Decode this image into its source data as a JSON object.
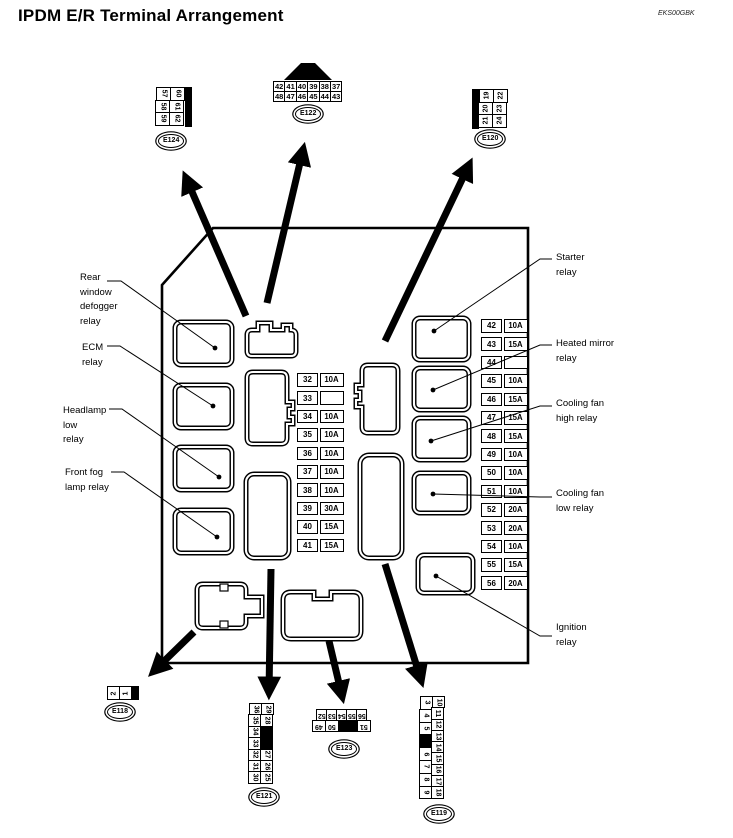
{
  "header": {
    "title": "IPDM E/R Terminal Arrangement",
    "doc_code": "EKS00GBK"
  },
  "colors": {
    "ink": "#000000",
    "paper": "#ffffff"
  },
  "labels": {
    "rear_window": [
      "Rear",
      "window",
      "defogger",
      "relay"
    ],
    "ecm": [
      "ECM",
      "relay"
    ],
    "headlamp_low": [
      "Headlamp",
      "low",
      "relay"
    ],
    "front_fog": [
      "Front fog",
      "lamp relay"
    ],
    "starter": [
      "Starter",
      "relay"
    ],
    "heated_mirror": [
      "Heated mirror",
      "relay"
    ],
    "cooling_fan_high": [
      "Cooling fan",
      "high relay"
    ],
    "cooling_fan_low": [
      "Cooling fan",
      "low relay"
    ],
    "ignition": [
      "Ignition",
      "relay"
    ]
  },
  "connectors": {
    "e122": {
      "label": "E122",
      "row_top": [
        "42",
        "41",
        "40",
        "39",
        "38",
        "37"
      ],
      "row_bottom": [
        "48",
        "47",
        "46",
        "45",
        "44",
        "43"
      ]
    },
    "e124": {
      "label": "E124",
      "col_left": [
        "57",
        "58",
        "59"
      ],
      "col_right": [
        "60",
        "61",
        "62"
      ]
    },
    "e120": {
      "label": "E120",
      "col_left": [
        "19",
        "20",
        "21"
      ],
      "col_right": [
        "22",
        "23",
        "24"
      ]
    },
    "e118": {
      "label": "E118",
      "cells": [
        "2",
        "1",
        null
      ]
    },
    "e121": {
      "label": "E121",
      "col_left": [
        "36",
        "35",
        "34",
        "33",
        "32",
        "31",
        "30"
      ],
      "col_right": [
        "29",
        "28",
        null,
        "27",
        "26",
        "25"
      ]
    },
    "e123": {
      "label": "E123",
      "row_top": [
        "52",
        "53",
        "54",
        "55",
        "56"
      ],
      "row_bottom": [
        "49",
        "50",
        null,
        "51"
      ]
    },
    "e119": {
      "label": "E119",
      "col_left": [
        "3",
        "4",
        "5",
        null,
        "6",
        "7",
        "8",
        "9"
      ],
      "col_right": [
        "10",
        "11",
        "12",
        "13",
        "14",
        "15",
        "16",
        "17",
        "18"
      ]
    }
  },
  "fuse_tables": {
    "left": [
      {
        "no": "32",
        "amp": "10A"
      },
      {
        "no": "33",
        "amp": ""
      },
      {
        "no": "34",
        "amp": "10A"
      },
      {
        "no": "35",
        "amp": "10A"
      },
      {
        "no": "36",
        "amp": "10A"
      },
      {
        "no": "37",
        "amp": "10A"
      },
      {
        "no": "38",
        "amp": "10A"
      },
      {
        "no": "39",
        "amp": "30A"
      },
      {
        "no": "40",
        "amp": "15A"
      },
      {
        "no": "41",
        "amp": "15A"
      }
    ],
    "right": [
      {
        "no": "42",
        "amp": "10A"
      },
      {
        "no": "43",
        "amp": "15A"
      },
      {
        "no": "44",
        "amp": ""
      },
      {
        "no": "45",
        "amp": "10A"
      },
      {
        "no": "46",
        "amp": "15A"
      },
      {
        "no": "47",
        "amp": "15A"
      },
      {
        "no": "48",
        "amp": "15A"
      },
      {
        "no": "49",
        "amp": "10A"
      },
      {
        "no": "50",
        "amp": "10A"
      },
      {
        "no": "51",
        "amp": "10A"
      },
      {
        "no": "52",
        "amp": "20A"
      },
      {
        "no": "53",
        "amp": "20A"
      },
      {
        "no": "54",
        "amp": "10A"
      },
      {
        "no": "55",
        "amp": "15A"
      },
      {
        "no": "56",
        "amp": "20A"
      }
    ]
  }
}
